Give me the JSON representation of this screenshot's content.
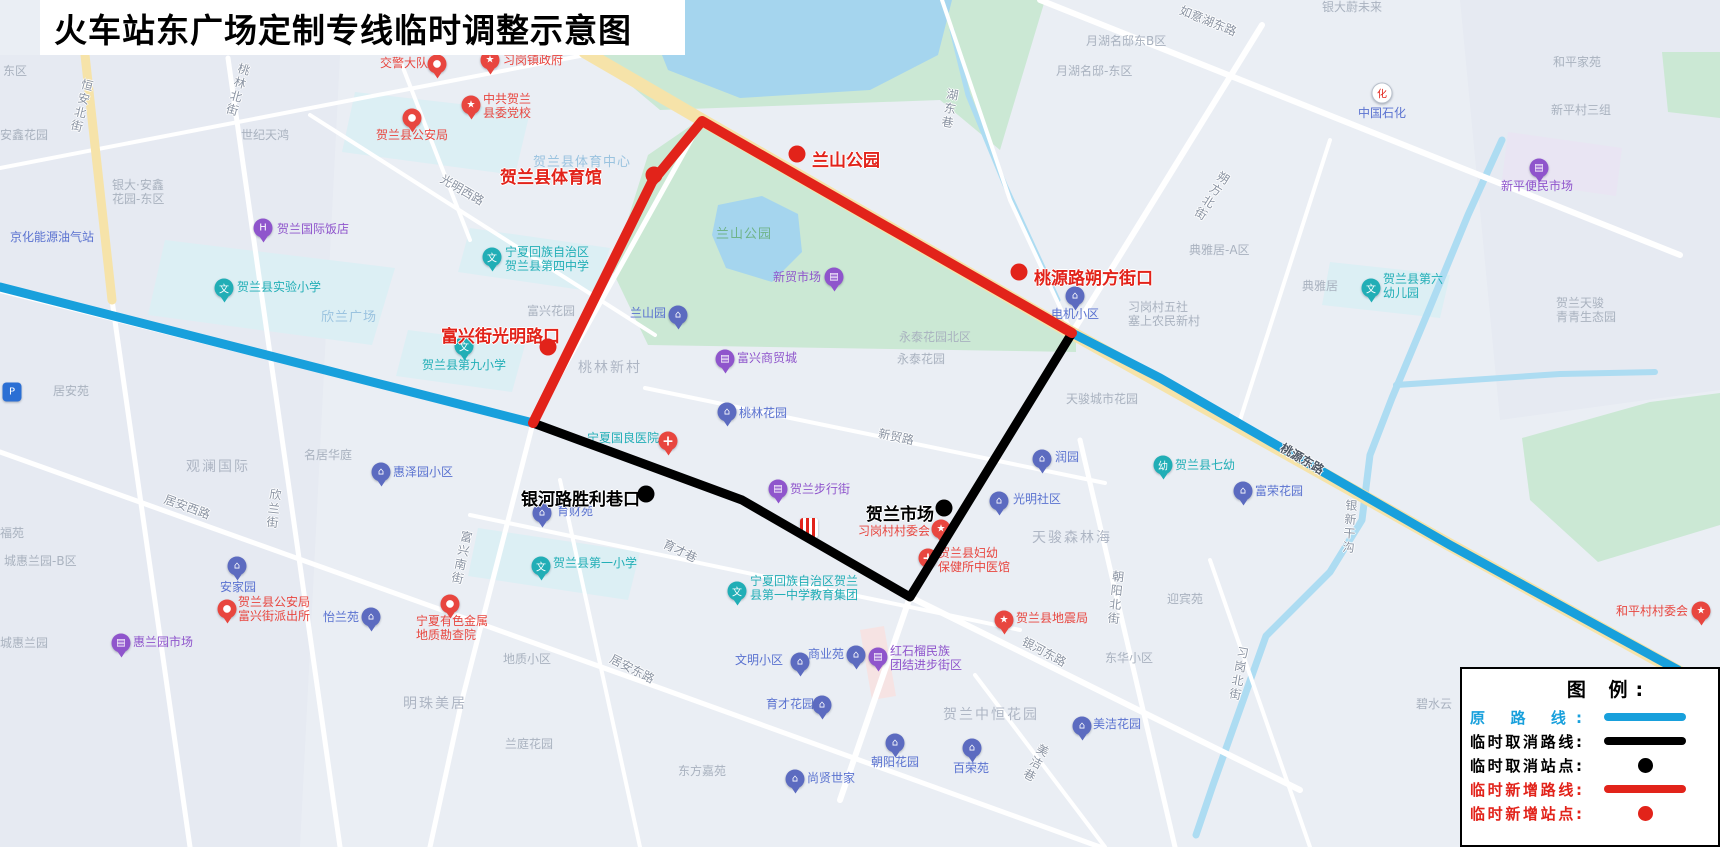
{
  "title": "火车站东广场定制专线临时调整示意图",
  "colors": {
    "route_original": "#18A0DC",
    "route_cancelled": "#000000",
    "route_added": "#E2231A",
    "bg": "#EAEEF4",
    "park": "#CBE8D4",
    "water": "#A5D5EE",
    "canal": "#ADDCF2",
    "road_yellow": "#F6E3A9"
  },
  "legend": {
    "title": "图 例:",
    "rows": [
      {
        "label": "原 路 线:",
        "symbol": "line",
        "color": "#18A0DC"
      },
      {
        "label": "临时取消路线:",
        "symbol": "line",
        "color": "#000000"
      },
      {
        "label": "临时取消站点:",
        "symbol": "dot",
        "color": "#000000"
      },
      {
        "label": "临时新增路线:",
        "symbol": "line",
        "color": "#E2231A"
      },
      {
        "label": "临时新增站点:",
        "symbol": "dot",
        "color": "#E2231A"
      }
    ]
  },
  "routes": {
    "original_west": [
      [
        0,
        287
      ],
      [
        533,
        423
      ]
    ],
    "original_east": [
      [
        1072,
        333
      ],
      [
        1160,
        378
      ],
      [
        1450,
        545
      ],
      [
        1678,
        670
      ]
    ],
    "cancelled": [
      [
        533,
        423
      ],
      [
        742,
        500
      ],
      [
        910,
        597
      ],
      [
        1072,
        333
      ]
    ],
    "added": [
      [
        533,
        423
      ],
      [
        652,
        182
      ],
      [
        702,
        121
      ],
      [
        1072,
        333
      ]
    ]
  },
  "stations": {
    "added": [
      {
        "name": "贺兰县体育馆",
        "lx": 500,
        "ly": 163,
        "dx": 654,
        "dy": 175
      },
      {
        "name": "兰山公园",
        "lx": 812,
        "ly": 146,
        "dx": 797,
        "dy": 154
      },
      {
        "name": "桃源路朔方街口",
        "lx": 1034,
        "ly": 264,
        "dx": 1019,
        "dy": 272
      },
      {
        "name": "富兴街光明路口",
        "lx": 441,
        "ly": 322,
        "dx": 548,
        "dy": 347
      }
    ],
    "cancelled": [
      {
        "name": "银河路胜利巷口",
        "lx": 521,
        "ly": 485,
        "dx": 646,
        "dy": 494
      },
      {
        "name": "贺兰市场",
        "lx": 866,
        "ly": 500,
        "dx": 944,
        "dy": 508
      }
    ]
  },
  "labels": [
    {
      "t": "东区",
      "x": 3,
      "y": 64,
      "s": "area"
    },
    {
      "t": "安鑫花园",
      "x": 0,
      "y": 128,
      "s": "area"
    },
    {
      "t": "银大·安鑫\n花园-东区",
      "x": 112,
      "y": 178,
      "s": "area"
    },
    {
      "t": "世纪天鸿",
      "x": 241,
      "y": 128,
      "s": "area"
    },
    {
      "t": "月湖名邸东B区",
      "x": 1086,
      "y": 34,
      "s": "area"
    },
    {
      "t": "月湖名邸-东区",
      "x": 1056,
      "y": 64,
      "s": "area"
    },
    {
      "t": "银大蔚未来",
      "x": 1322,
      "y": 0,
      "s": "area"
    },
    {
      "t": "和平家苑",
      "x": 1553,
      "y": 55,
      "s": "area"
    },
    {
      "t": "新平村三组",
      "x": 1551,
      "y": 103,
      "s": "area"
    },
    {
      "t": "典雅居-A区",
      "x": 1189,
      "y": 243,
      "s": "area"
    },
    {
      "t": "典雅居",
      "x": 1302,
      "y": 279,
      "s": "area"
    },
    {
      "t": "习岗村五社\n塞上农民新村",
      "x": 1128,
      "y": 300,
      "s": "area"
    },
    {
      "t": "永泰花园北区",
      "x": 899,
      "y": 330,
      "s": "area"
    },
    {
      "t": "永泰花园",
      "x": 897,
      "y": 352,
      "s": "area"
    },
    {
      "t": "天骏城市花园",
      "x": 1066,
      "y": 392,
      "s": "area"
    },
    {
      "t": "天骏森林海",
      "x": 1032,
      "y": 530,
      "s": "area-lg"
    },
    {
      "t": "观澜国际",
      "x": 186,
      "y": 459,
      "s": "area-lg"
    },
    {
      "t": "名居华庭",
      "x": 304,
      "y": 448,
      "s": "area"
    },
    {
      "t": "居安苑",
      "x": 53,
      "y": 384,
      "s": "area"
    },
    {
      "t": "福苑",
      "x": 0,
      "y": 526,
      "s": "area"
    },
    {
      "t": "城惠兰园-B区",
      "x": 4,
      "y": 554,
      "s": "area"
    },
    {
      "t": "城惠兰园",
      "x": 0,
      "y": 636,
      "s": "area"
    },
    {
      "t": "明珠美居",
      "x": 403,
      "y": 696,
      "s": "area-lg"
    },
    {
      "t": "兰庭花园",
      "x": 505,
      "y": 737,
      "s": "area"
    },
    {
      "t": "地质小区",
      "x": 503,
      "y": 652,
      "s": "area"
    },
    {
      "t": "东方嘉苑",
      "x": 678,
      "y": 764,
      "s": "area"
    },
    {
      "t": "桃林新村",
      "x": 578,
      "y": 360,
      "s": "area-lg"
    },
    {
      "t": "富兴花园",
      "x": 527,
      "y": 304,
      "s": "area"
    },
    {
      "t": "东华小区",
      "x": 1105,
      "y": 651,
      "s": "area"
    },
    {
      "t": "迎宾苑",
      "x": 1167,
      "y": 592,
      "s": "area"
    },
    {
      "t": "贺兰中恒花园",
      "x": 943,
      "y": 707,
      "s": "area-lg"
    },
    {
      "t": "碧水云",
      "x": 1416,
      "y": 697,
      "s": "area"
    },
    {
      "t": "贺兰天骏\n青青生态园",
      "x": 1556,
      "y": 296,
      "s": "area"
    },
    {
      "t": "欣兰广场",
      "x": 321,
      "y": 310,
      "s": "lb"
    },
    {
      "t": "贺兰县体育中心",
      "x": 533,
      "y": 155,
      "s": "lb"
    },
    {
      "t": "兰山公园",
      "x": 716,
      "y": 227,
      "s": "green"
    },
    {
      "t": "京化能源油气站",
      "x": 10,
      "y": 230,
      "s": "blue"
    },
    {
      "t": "贺兰国际饭店",
      "x": 277,
      "y": 222,
      "s": "purple"
    },
    {
      "t": "贺兰县实验小学",
      "x": 237,
      "y": 280,
      "s": "teal"
    },
    {
      "t": "宁夏回族自治区\n贺兰县第四中学",
      "x": 505,
      "y": 245,
      "s": "teal"
    },
    {
      "t": "贺兰县第九小学",
      "x": 422,
      "y": 358,
      "s": "teal"
    },
    {
      "t": "贺兰县第一小学",
      "x": 553,
      "y": 556,
      "s": "teal"
    },
    {
      "t": "宁夏回族自治区贺兰\n县第一中学教育集团",
      "x": 750,
      "y": 574,
      "s": "teal"
    },
    {
      "t": "贺兰县第六\n幼儿园",
      "x": 1383,
      "y": 272,
      "s": "teal"
    },
    {
      "t": "贺兰县七幼",
      "x": 1175,
      "y": 458,
      "s": "teal"
    },
    {
      "t": "宁夏国良医院",
      "x": 587,
      "y": 431,
      "s": "teal"
    },
    {
      "t": "新贸市场",
      "x": 773,
      "y": 270,
      "s": "purple"
    },
    {
      "t": "富兴商贸城",
      "x": 737,
      "y": 351,
      "s": "purple"
    },
    {
      "t": "贺兰步行街",
      "x": 790,
      "y": 482,
      "s": "purple"
    },
    {
      "t": "惠兰园市场",
      "x": 133,
      "y": 635,
      "s": "purple"
    },
    {
      "t": "新平便民市场",
      "x": 1501,
      "y": 179,
      "s": "purple"
    },
    {
      "t": "红石榴民族\n团结进步街区",
      "x": 890,
      "y": 644,
      "s": "purple"
    },
    {
      "t": "中国石化",
      "x": 1358,
      "y": 106,
      "s": "blue"
    },
    {
      "t": "育财苑",
      "x": 557,
      "y": 504,
      "s": "blue"
    },
    {
      "t": "惠泽园小区",
      "x": 393,
      "y": 465,
      "s": "blue"
    },
    {
      "t": "润园",
      "x": 1055,
      "y": 450,
      "s": "blue"
    },
    {
      "t": "光明社区",
      "x": 1013,
      "y": 492,
      "s": "blue"
    },
    {
      "t": "电机小区",
      "x": 1051,
      "y": 307,
      "s": "blue"
    },
    {
      "t": "兰山园",
      "x": 630,
      "y": 306,
      "s": "blue"
    },
    {
      "t": "桃林花园",
      "x": 739,
      "y": 406,
      "s": "blue"
    },
    {
      "t": "安家园",
      "x": 220,
      "y": 580,
      "s": "blue"
    },
    {
      "t": "怡兰苑",
      "x": 323,
      "y": 610,
      "s": "blue"
    },
    {
      "t": "商业苑",
      "x": 808,
      "y": 647,
      "s": "blue"
    },
    {
      "t": "文明小区",
      "x": 735,
      "y": 653,
      "s": "blue"
    },
    {
      "t": "育才花园",
      "x": 766,
      "y": 697,
      "s": "blue"
    },
    {
      "t": "朝阳花园",
      "x": 871,
      "y": 755,
      "s": "blue"
    },
    {
      "t": "百荣苑",
      "x": 953,
      "y": 761,
      "s": "blue"
    },
    {
      "t": "尚贤世家",
      "x": 807,
      "y": 771,
      "s": "blue"
    },
    {
      "t": "美洁花园",
      "x": 1093,
      "y": 717,
      "s": "blue"
    },
    {
      "t": "富荣花园",
      "x": 1255,
      "y": 484,
      "s": "blue"
    },
    {
      "t": "交警大队",
      "x": 380,
      "y": 56,
      "s": "redpoi"
    },
    {
      "t": "习岗镇政府",
      "x": 503,
      "y": 53,
      "s": "redpoi"
    },
    {
      "t": "中共贺兰\n县委党校",
      "x": 483,
      "y": 92,
      "s": "redpoi"
    },
    {
      "t": "贺兰县公安局",
      "x": 376,
      "y": 128,
      "s": "redpoi"
    },
    {
      "t": "贺兰县公安局\n富兴街派出所",
      "x": 238,
      "y": 595,
      "s": "redpoi"
    },
    {
      "t": "宁夏有色金属\n地质勘查院",
      "x": 416,
      "y": 614,
      "s": "redpoi"
    },
    {
      "t": "贺兰县地震局",
      "x": 1016,
      "y": 611,
      "s": "redpoi"
    },
    {
      "t": "习岗村村委会",
      "x": 858,
      "y": 524,
      "s": "redpoi"
    },
    {
      "t": "贺兰县妇幼\n保健所中医馆",
      "x": 938,
      "y": 546,
      "s": "redpoi"
    },
    {
      "t": "和平村村委会",
      "x": 1616,
      "y": 604,
      "s": "redpoi"
    },
    {
      "t": "恒安北街",
      "x": 74,
      "y": 78,
      "s": "roadv",
      "r": 14
    },
    {
      "t": "桃林北街",
      "x": 230,
      "y": 62,
      "s": "roadv",
      "r": 16
    },
    {
      "t": "光明西路",
      "x": 438,
      "y": 183,
      "s": "road",
      "r": 30
    },
    {
      "t": "湖东巷",
      "x": 942,
      "y": 88,
      "s": "roadv",
      "r": 10
    },
    {
      "t": "如意湖东路",
      "x": 1178,
      "y": 14,
      "s": "road",
      "r": 22
    },
    {
      "t": "朔方北街",
      "x": 1204,
      "y": 168,
      "s": "roadv",
      "r": 32
    },
    {
      "t": "居安西路",
      "x": 163,
      "y": 500,
      "s": "road",
      "r": 20
    },
    {
      "t": "欣兰街",
      "x": 266,
      "y": 488,
      "s": "roadv",
      "r": 6
    },
    {
      "t": "富兴南街",
      "x": 454,
      "y": 530,
      "s": "roadv",
      "r": 12
    },
    {
      "t": "育才巷",
      "x": 662,
      "y": 544,
      "s": "road",
      "r": 26
    },
    {
      "t": "居安东路",
      "x": 608,
      "y": 662,
      "s": "road",
      "r": 27
    },
    {
      "t": "新贸路",
      "x": 878,
      "y": 430,
      "s": "road",
      "r": 12
    },
    {
      "t": "银河东路",
      "x": 1020,
      "y": 645,
      "s": "road",
      "r": 28
    },
    {
      "t": "美洁巷",
      "x": 1028,
      "y": 742,
      "s": "roadv",
      "r": 28
    },
    {
      "t": "朝阳北街",
      "x": 1108,
      "y": 570,
      "s": "roadv",
      "r": 6
    },
    {
      "t": "习岗北街",
      "x": 1231,
      "y": 646,
      "s": "roadv",
      "r": 10
    },
    {
      "t": "银新干沟",
      "x": 1342,
      "y": 499,
      "s": "water roadv",
      "r": 4
    },
    {
      "t": "桃源东路",
      "x": 1278,
      "y": 452,
      "s": "roadtop",
      "r": 30
    }
  ],
  "pois": [
    {
      "i": "school",
      "x": 224,
      "y": 288
    },
    {
      "i": "school",
      "x": 492,
      "y": 257
    },
    {
      "i": "school",
      "x": 464,
      "y": 346
    },
    {
      "i": "school",
      "x": 541,
      "y": 566
    },
    {
      "i": "school",
      "x": 737,
      "y": 591
    },
    {
      "i": "school",
      "x": 1371,
      "y": 288
    },
    {
      "i": "kind",
      "x": 1163,
      "y": 465
    },
    {
      "i": "pin-cross",
      "x": 668,
      "y": 441
    },
    {
      "i": "res",
      "x": 542,
      "y": 513
    },
    {
      "i": "res",
      "x": 381,
      "y": 472
    },
    {
      "i": "res",
      "x": 1042,
      "y": 459
    },
    {
      "i": "res",
      "x": 999,
      "y": 501
    },
    {
      "i": "res",
      "x": 1075,
      "y": 296
    },
    {
      "i": "res",
      "x": 678,
      "y": 315
    },
    {
      "i": "res",
      "x": 727,
      "y": 412
    },
    {
      "i": "res",
      "x": 237,
      "y": 566
    },
    {
      "i": "res",
      "x": 371,
      "y": 617
    },
    {
      "i": "res",
      "x": 856,
      "y": 655
    },
    {
      "i": "res",
      "x": 800,
      "y": 662
    },
    {
      "i": "res",
      "x": 822,
      "y": 705
    },
    {
      "i": "res",
      "x": 895,
      "y": 743
    },
    {
      "i": "res",
      "x": 972,
      "y": 748
    },
    {
      "i": "res",
      "x": 795,
      "y": 779
    },
    {
      "i": "res",
      "x": 1082,
      "y": 726
    },
    {
      "i": "res",
      "x": 1243,
      "y": 491
    },
    {
      "i": "shop",
      "x": 121,
      "y": 643
    },
    {
      "i": "shop",
      "x": 834,
      "y": 277
    },
    {
      "i": "shop",
      "x": 725,
      "y": 359
    },
    {
      "i": "shop",
      "x": 778,
      "y": 489
    },
    {
      "i": "shop",
      "x": 878,
      "y": 657
    },
    {
      "i": "shop",
      "x": 1539,
      "y": 168
    },
    {
      "i": "hotel",
      "x": 263,
      "y": 228
    },
    {
      "i": "pin",
      "x": 227,
      "y": 609
    },
    {
      "i": "pin",
      "x": 450,
      "y": 604
    },
    {
      "i": "pin-star",
      "x": 1004,
      "y": 620
    },
    {
      "i": "pin-cross",
      "x": 928,
      "y": 558
    },
    {
      "i": "pin-star",
      "x": 941,
      "y": 529
    },
    {
      "i": "pin-star",
      "x": 1701,
      "y": 611
    },
    {
      "i": "pin",
      "x": 412,
      "y": 118
    },
    {
      "i": "pin-star",
      "x": 471,
      "y": 105
    },
    {
      "i": "pin",
      "x": 437,
      "y": 64
    },
    {
      "i": "pin-star",
      "x": 490,
      "y": 60
    },
    {
      "i": "petro",
      "x": 1382,
      "y": 93
    },
    {
      "i": "parking",
      "x": 12,
      "y": 392
    },
    {
      "i": "kfc",
      "x": 809,
      "y": 528
    }
  ]
}
